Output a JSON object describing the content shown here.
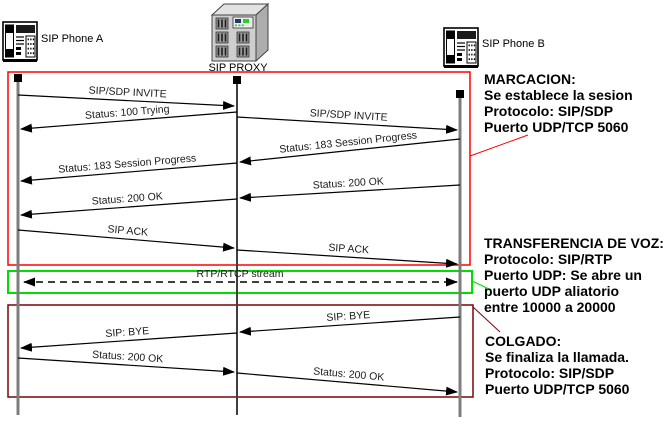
{
  "canvas": {
    "width": 672,
    "height": 433,
    "background": "#ffffff"
  },
  "colors": {
    "arrow": "#000000",
    "message_text": "#1a1a1a",
    "annotation_text": "#000000",
    "marcacion_box": "#ff0000",
    "voice_box": "#00dd00",
    "colgado_box": "#7b0404"
  },
  "actors": [
    {
      "id": "phoneA",
      "label": "SIP Phone A",
      "icon": "desk-phone-icon",
      "x": 18,
      "square_y": 78,
      "line_bottom": 415,
      "line_color": "#7d7d7d",
      "line_width": 3,
      "icon_x": 3,
      "icon_y": 19,
      "label_x": 41,
      "label_y": 42
    },
    {
      "id": "proxy",
      "label": "SIP PROXY",
      "icon": "server-icon",
      "x": 237,
      "square_y": 80,
      "line_bottom": 415,
      "line_color": "#3f3f3f",
      "line_width": 2,
      "icon_x": 212,
      "icon_y": 3,
      "label_x": 238,
      "label_y": 71,
      "label_anchor": "middle"
    },
    {
      "id": "phoneB",
      "label": "SIP Phone B",
      "icon": "desk-phone-icon",
      "x": 460,
      "square_y": 94,
      "line_bottom": 417,
      "line_color": "#7d7d7d",
      "line_width": 3,
      "icon_x": 444,
      "icon_y": 25,
      "label_x": 482,
      "label_y": 47
    }
  ],
  "sections": [
    {
      "id": "marcacion",
      "box": {
        "x": 8,
        "y": 72,
        "w": 462,
        "h": 193,
        "color": "#ff0000",
        "stroke_width": 1.5
      },
      "leader": {
        "points": [
          [
            470,
            156
          ],
          [
            528,
            135
          ]
        ],
        "color": "#ff0000"
      },
      "annotation": {
        "x": 484,
        "y": 84,
        "line_height": 16,
        "lines": [
          "MARCACION:",
          "Se establece la sesion",
          "Protocolo: SIP/SDP",
          "Puerto UDP/TCP 5060"
        ]
      }
    },
    {
      "id": "transferencia-voz",
      "box": {
        "x": 8,
        "y": 271,
        "w": 464,
        "h": 22,
        "color": "#00dd00",
        "stroke_width": 2
      },
      "leader": {
        "points": [
          [
            472,
            281
          ],
          [
            489,
            289
          ]
        ],
        "color": "#00dd00"
      },
      "annotation": {
        "x": 484,
        "y": 248,
        "line_height": 16,
        "lines": [
          "TRANSFERENCIA DE VOZ:",
          "Protocolo: SIP/RTP",
          "Puerto UDP: Se abre un",
          "puerto UDP aliatorio",
          "entre 10000 a 20000"
        ]
      }
    },
    {
      "id": "colgado",
      "box": {
        "x": 8,
        "y": 305,
        "w": 465,
        "h": 92,
        "color": "#7b0404",
        "stroke_width": 1.5
      },
      "leader": {
        "points": [
          [
            473,
            307
          ],
          [
            500,
            332
          ]
        ],
        "color": "#7b0404"
      },
      "annotation": {
        "x": 485,
        "y": 346,
        "line_height": 16,
        "lines": [
          "COLGADO:",
          "Se finaliza la llamada.",
          "Protocolo: SIP/SDP",
          "Puerto UDP/TCP 5060"
        ]
      }
    }
  ],
  "messages": [
    {
      "label": "SIP/SDP INVITE",
      "from": "phoneA",
      "to": "proxy",
      "y1": 95,
      "y2": 106
    },
    {
      "label": "Status: 100 Trying",
      "from": "proxy",
      "to": "phoneA",
      "y1": 112,
      "y2": 129
    },
    {
      "label": "SIP/SDP INVITE",
      "from": "proxy",
      "to": "phoneB",
      "y1": 117,
      "y2": 130
    },
    {
      "label": "Status: 183 Session Progress",
      "from": "phoneB",
      "to": "proxy",
      "y1": 139,
      "y2": 162
    },
    {
      "label": "Status: 183 Session Progress",
      "from": "proxy",
      "to": "phoneA",
      "y1": 163,
      "y2": 181
    },
    {
      "label": "Status: 200 OK",
      "from": "phoneB",
      "to": "proxy",
      "y1": 185,
      "y2": 198
    },
    {
      "label": "Status: 200 OK",
      "from": "proxy",
      "to": "phoneA",
      "y1": 199,
      "y2": 215
    },
    {
      "label": "SIP ACK",
      "from": "phoneA",
      "to": "proxy",
      "y1": 230,
      "y2": 248
    },
    {
      "label": "SIP ACK",
      "from": "proxy",
      "to": "phoneB",
      "y1": 250,
      "y2": 264
    },
    {
      "label": "RTP/RTCP stream",
      "from": "phoneA",
      "to": "phoneB",
      "y1": 282,
      "y2": 282,
      "dashed": true,
      "double": true,
      "label_x": 240
    },
    {
      "label": "SIP: BYE",
      "from": "phoneB",
      "to": "proxy",
      "y1": 317,
      "y2": 332
    },
    {
      "label": "SIP: BYE",
      "from": "proxy",
      "to": "phoneA",
      "y1": 333,
      "y2": 348
    },
    {
      "label": "Status: 200 OK",
      "from": "phoneA",
      "to": "proxy",
      "y1": 358,
      "y2": 372
    },
    {
      "label": "Status: 200 OK",
      "from": "proxy",
      "to": "phoneB",
      "y1": 373,
      "y2": 392
    }
  ]
}
